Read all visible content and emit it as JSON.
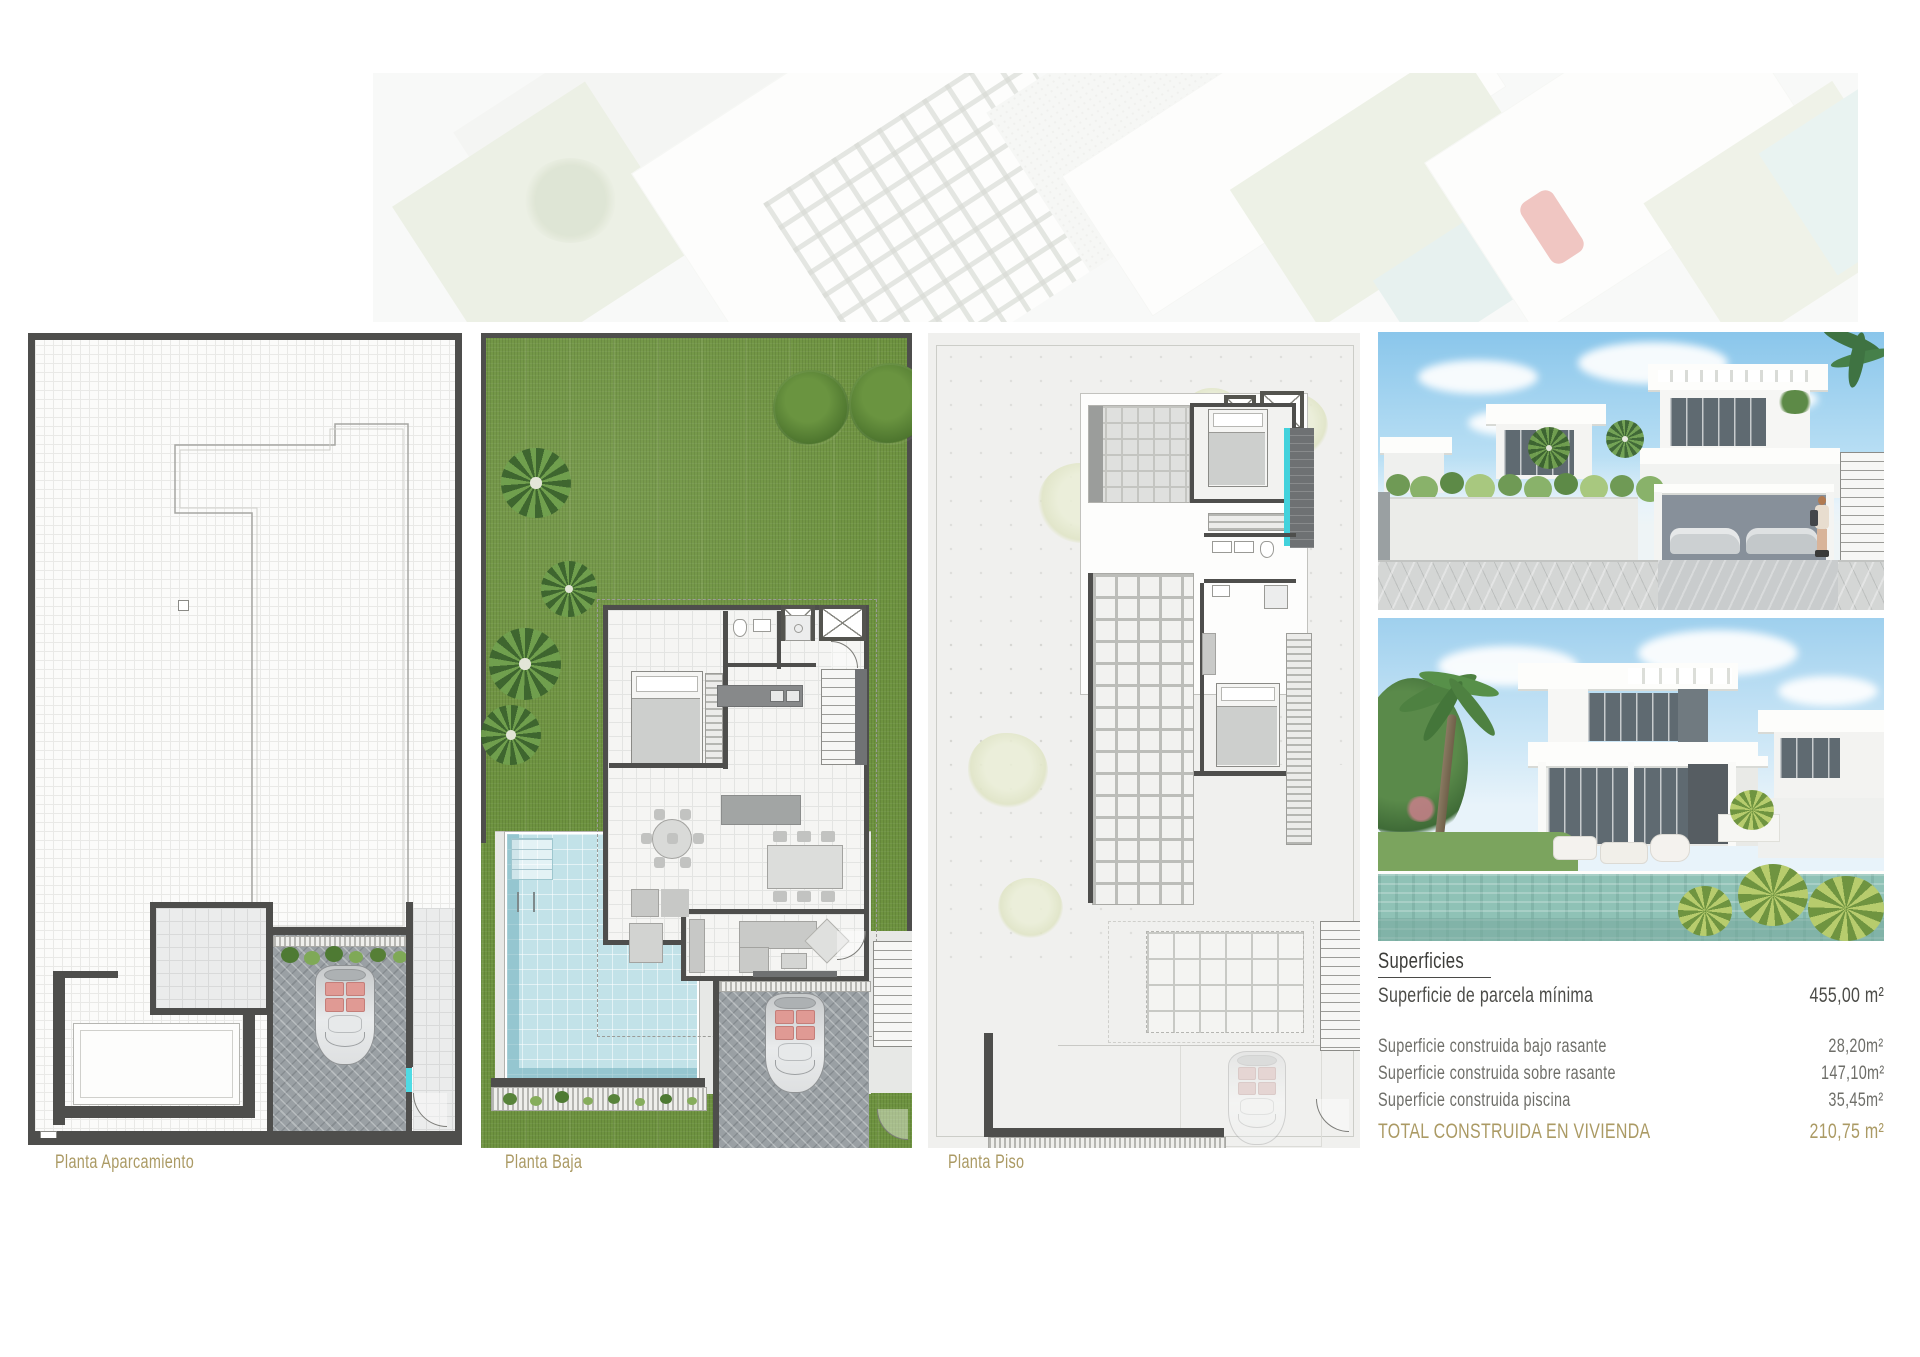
{
  "plans": {
    "parking": {
      "label": "Planta Aparcamiento"
    },
    "ground": {
      "label": "Planta Baja"
    },
    "upper": {
      "label": "Planta Piso"
    }
  },
  "surfaces": {
    "title": "Superficies",
    "main_row": {
      "label": "Superficie de parcela mínima",
      "value": "455,00 m²"
    },
    "rows": [
      {
        "label": "Superficie construida bajo rasante",
        "value": "28,20m²"
      },
      {
        "label": "Superficie construida sobre rasante",
        "value": "147,10m²"
      },
      {
        "label": "Superficie construida piscina",
        "value": "35,45m²"
      }
    ],
    "total_row": {
      "label": "TOTAL CONSTRUIDA EN VIVIENDA",
      "value": "210,75 m²"
    }
  },
  "colors": {
    "accent_gold": "#ab9a64",
    "wall_dark": "#4e4e4c",
    "grass_green": "#6e9340",
    "pool_blue": "#c2e2e8",
    "sky_blue": "#8ac6eb",
    "text_dark": "#3d3d3a",
    "text_gray": "#6e6e69"
  }
}
